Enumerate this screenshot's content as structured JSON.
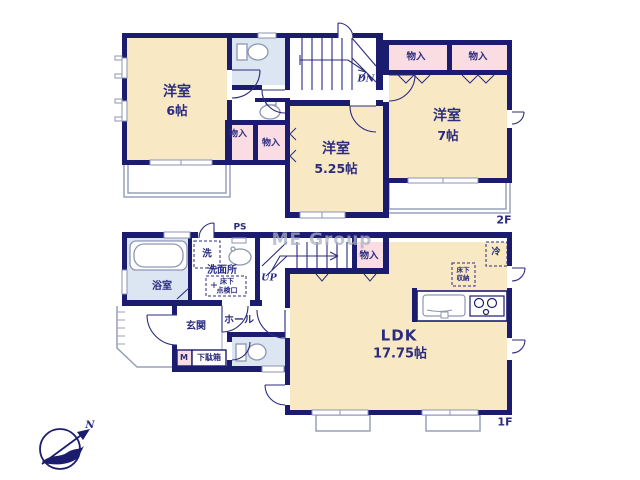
{
  "watermark": "ME Group",
  "compass": {
    "north": "N"
  },
  "colors": {
    "wall": "#1c1c6e",
    "room_cream": "#f8e8c4",
    "closet_pink": "#fadde2",
    "wet_area_blue": "#dbe6f2",
    "line_grey": "#97a0ba",
    "text_navy": "#2b2b80"
  },
  "floor2": {
    "label": "2F",
    "stairs": "DN",
    "room_west": {
      "name": "洋室",
      "size": "6帖"
    },
    "room_center": {
      "name": "洋室",
      "size": "5.25帖"
    },
    "room_east": {
      "name": "洋室",
      "size": "7帖"
    },
    "closets": [
      "物入",
      "物入",
      "物入",
      "物入"
    ]
  },
  "floor1": {
    "label": "1F",
    "stairs": "UP",
    "ldk": {
      "name": "LDK",
      "size": "17.75帖"
    },
    "bathroom": "浴室",
    "washroom": "洗面所",
    "laundry": "洗",
    "entrance": "玄関",
    "hall": "ホール",
    "closet": "物入",
    "pipe_space": "PS",
    "refrigerator": "冷",
    "underfloor_inspection": {
      "line1": "床下",
      "line2": "点検口"
    },
    "underfloor_storage": {
      "line1": "床下",
      "line2": "収納"
    },
    "shoebox_m": "M",
    "shoebox": "下駄箱"
  }
}
